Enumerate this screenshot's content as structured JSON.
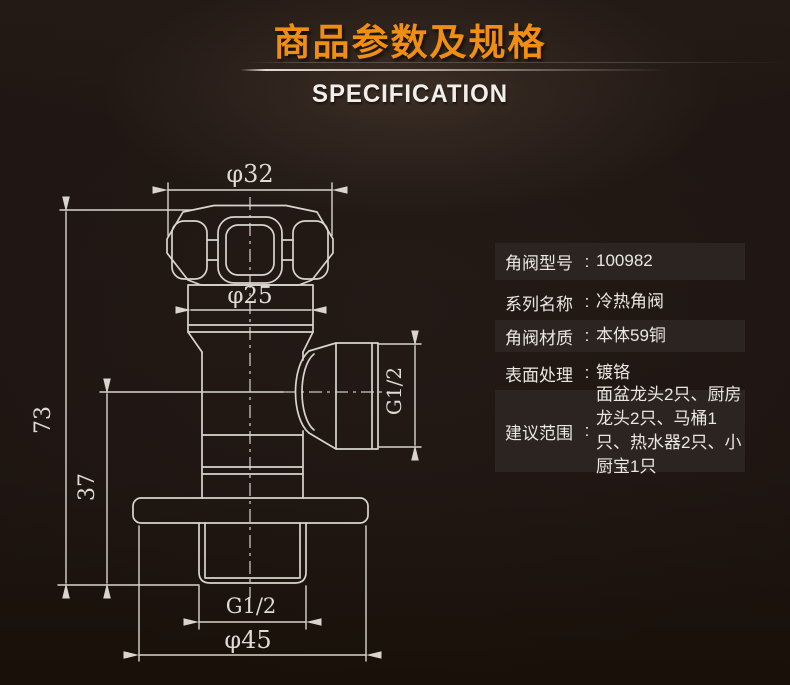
{
  "header": {
    "title": "商品参数及规格",
    "subtitle": "SPECIFICATION",
    "title_color": "#ef8e12"
  },
  "drawing": {
    "line_color": "#d9d4cd",
    "labels": {
      "top_width": "φ32",
      "collar_width": "φ25",
      "total_height": "73",
      "lower_height": "37",
      "side_thread": "G1/2",
      "bottom_thread": "G1/2",
      "flange_width": "φ45"
    }
  },
  "specs": {
    "colon": ":",
    "text_color": "#eae6e1",
    "row_box_color": "#2b2420",
    "rows": [
      {
        "label": "角阀型号",
        "value": "100982",
        "boxed": true
      },
      {
        "label": "系列名称",
        "value": "冷热角阀",
        "boxed": false
      },
      {
        "label": "角阀材质",
        "value": "本体59铜",
        "boxed": true
      },
      {
        "label": "表面处理",
        "value": "镀铬",
        "boxed": false
      },
      {
        "label": "建议范围",
        "value": "面盆龙头2只、厨房龙头2只、马桶1只、热水器2只、小厨宝1只",
        "boxed": true
      }
    ]
  }
}
